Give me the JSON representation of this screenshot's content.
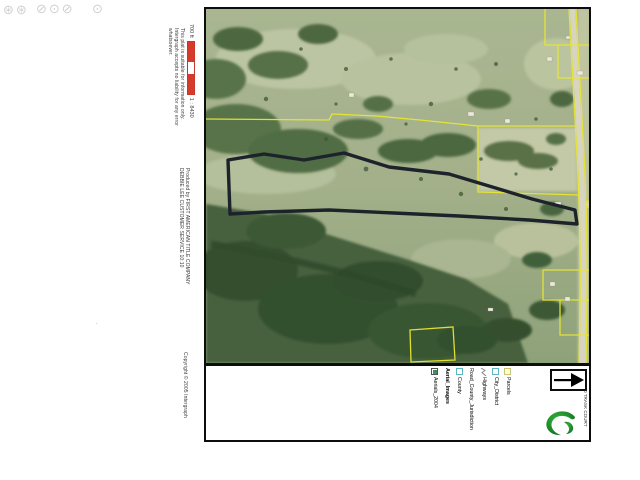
{
  "artifacts": {
    "stamp1": "⊛⊛",
    "stamp2": "⊘⊙⊘",
    "stamp3": "⊙",
    "speck": "·"
  },
  "scale": {
    "distance_label": "700 ft",
    "ratio_label": "1 : 8430",
    "bar_color": "#d63a2a"
  },
  "disclaimer": {
    "line1": "This plat is suitable for information only.",
    "line2": "Intergraph accepts no liability for any error",
    "line3": "whatsoever."
  },
  "producer": {
    "line1": "Produced by FIRST AMERICAN TITLE COMPANY",
    "line2": "DEBBIE LEE CUSTOMER SERVICE 10:10"
  },
  "copyright": {
    "text": "Copyright © 2005 Intergraph"
  },
  "map": {
    "title": "0 TRASK COURT",
    "subject_outline_color": "#1d232b",
    "parcel_line_color": "#e8e632",
    "photo_base_color": "#a8b58e"
  },
  "legend": {
    "items": [
      {
        "label": "Parcels",
        "symbol": "parcel-swatch",
        "header": false
      },
      {
        "label": "City_District",
        "symbol": "district-swatch",
        "header": false
      },
      {
        "label": "Highways",
        "symbol": "highway-line",
        "header": false
      },
      {
        "label": "Road_County_Jurisdiction",
        "symbol": "none",
        "header": false
      },
      {
        "label": "County",
        "symbol": "county-swatch",
        "header": false
      },
      {
        "label": "Aerial_Images",
        "symbol": "none",
        "header": true
      },
      {
        "label": "Aerials_2004",
        "symbol": "image-checkbox",
        "header": false
      }
    ]
  }
}
